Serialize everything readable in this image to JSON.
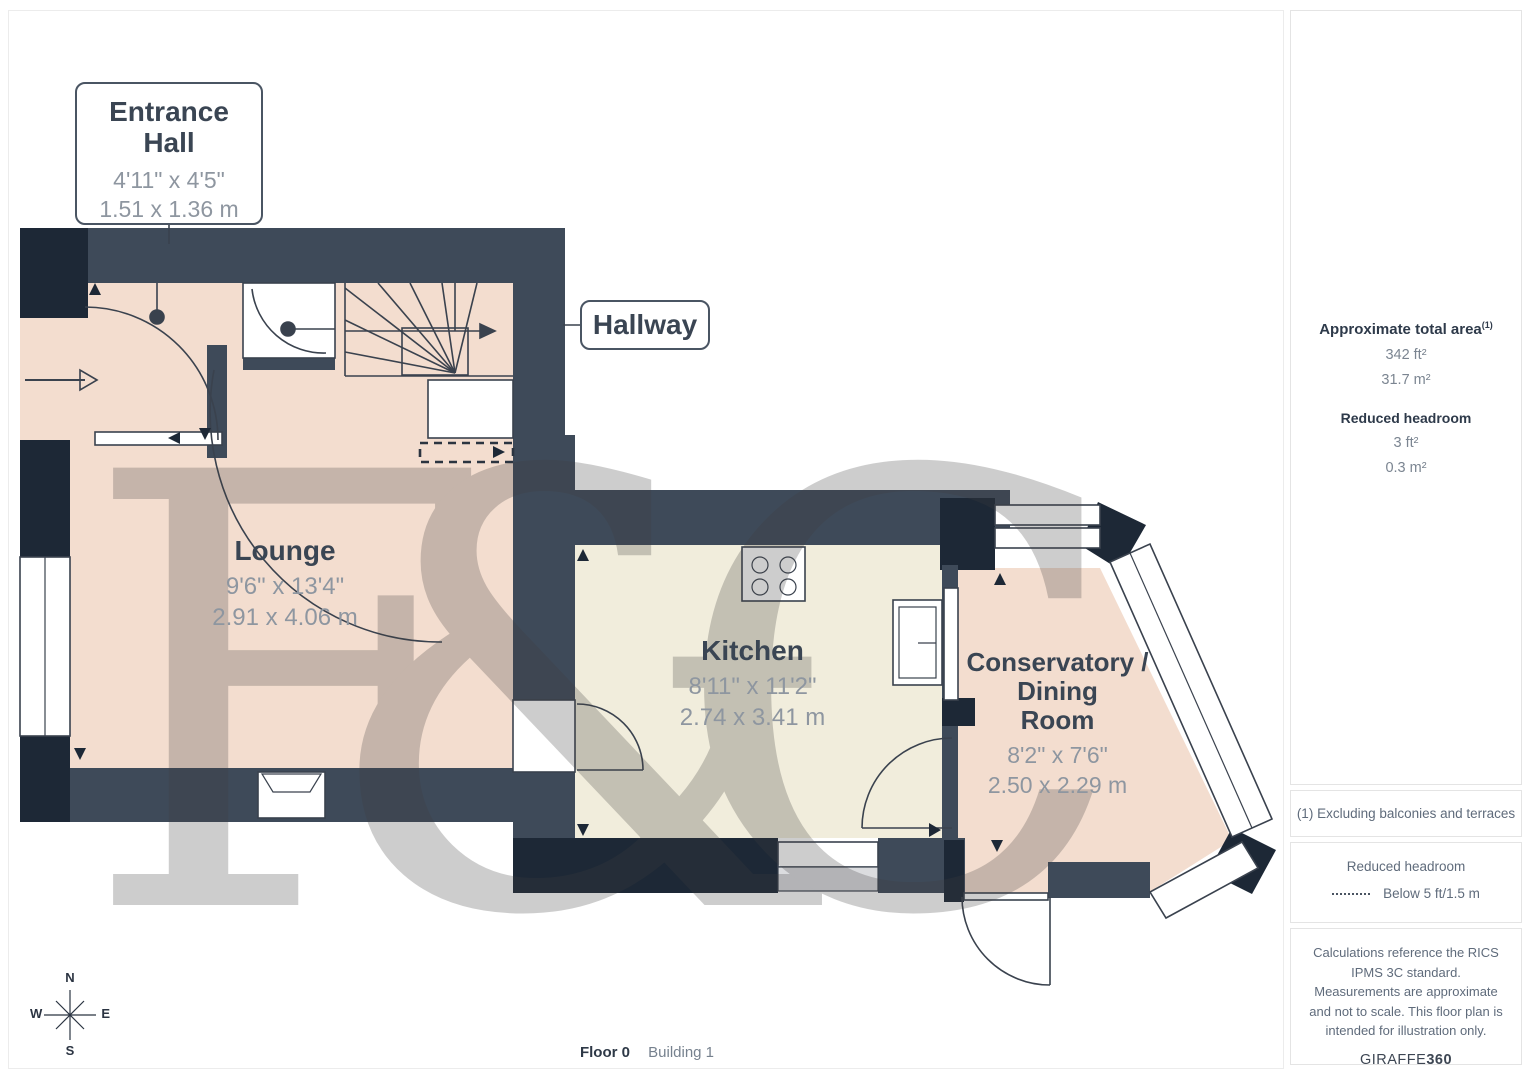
{
  "rooms": {
    "entrance_hall": {
      "name": "Entrance\nHall",
      "imperial": "4'11\" x 4'5\"",
      "metric": "1.51 x 1.36 m"
    },
    "hallway": {
      "name": "Hallway"
    },
    "lounge": {
      "name": "Lounge",
      "imperial": "9'6\" x 13'4\"",
      "metric": "2.91 x 4.06 m"
    },
    "kitchen": {
      "name": "Kitchen",
      "imperial": "8'11\" x 11'2\"",
      "metric": "2.74 x 3.41 m"
    },
    "conservatory": {
      "name": "Conservatory /\nDining\nRoom",
      "imperial": "8'2\" x 7'6\"",
      "metric": "2.50 x 2.29 m"
    }
  },
  "sidebar": {
    "total_area_label": "Approximate total area",
    "total_area_sup": "(1)",
    "total_area_imperial": "342 ft²",
    "total_area_metric": "31.7 m²",
    "reduced_headroom_label": "Reduced headroom",
    "reduced_headroom_imperial": "3 ft²",
    "reduced_headroom_metric": "0.3 m²",
    "note1": "(1) Excluding balconies and terraces",
    "legend_title": "Reduced headroom",
    "legend_text": "Below 5 ft/1.5 m",
    "disclaimer": "Calculations reference the RICS IPMS 3C standard. Measurements are approximate and not to scale. This floor plan is intended for illustration only.",
    "brand_name": "GIRAFFE",
    "brand_suffix": "360"
  },
  "footer": {
    "floor": "Floor 0",
    "building": "Building 1"
  },
  "compass": {
    "n": "N",
    "e": "E",
    "s": "S",
    "w": "W"
  },
  "watermark": {
    "text": "F&C"
  },
  "colors": {
    "wall_slate": "#3e4a59",
    "wall_navy": "#1d2836",
    "floor_warm": "#f3ddcf",
    "floor_cream": "#f1eddc",
    "line": "#3a424e",
    "room_name": "#3a4553",
    "room_dims": "#8e96a0",
    "border_light": "#e4e4e4",
    "note_text": "#5f6b7b",
    "title_dark": "#2e3a4a",
    "watermark": "#3e3e3e"
  }
}
